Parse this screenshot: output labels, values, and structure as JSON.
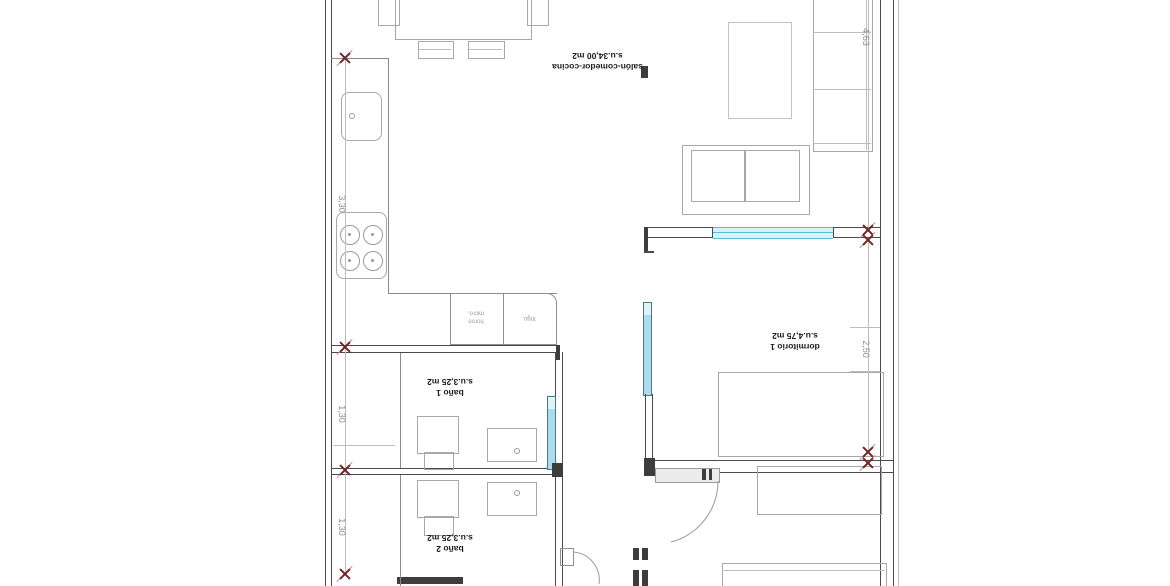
{
  "plan": {
    "rooms": {
      "salon": {
        "name": "salón-comedor-cocina",
        "area": "s.u.34,00 m2"
      },
      "dormitorio1": {
        "name": "dormitorio 1",
        "area": "s.u.4,75 m2"
      },
      "bano1": {
        "name": "baño 1",
        "area": "s.u.3,25 m2"
      },
      "bano2": {
        "name": "baño 2",
        "area": "s.u.3,25 m2"
      }
    },
    "dimensions": {
      "right_top": "4,63",
      "right_middle": "2,50",
      "left_top": "3,30",
      "left_middle": "1,30",
      "left_bottom": "1,30"
    },
    "kitchen_labels": {
      "oven_line1": "horno",
      "oven_line2": "micro.",
      "fridge": "frigo."
    },
    "colors": {
      "wall": "#4a4a4a",
      "furniture_outline": "#a8a8a8",
      "window_cyan": "#56bfd6",
      "door_leaf_fill": "#aadcee",
      "dimension_marker": "#6f2626",
      "dimension_text": "#8f8f8f"
    }
  }
}
